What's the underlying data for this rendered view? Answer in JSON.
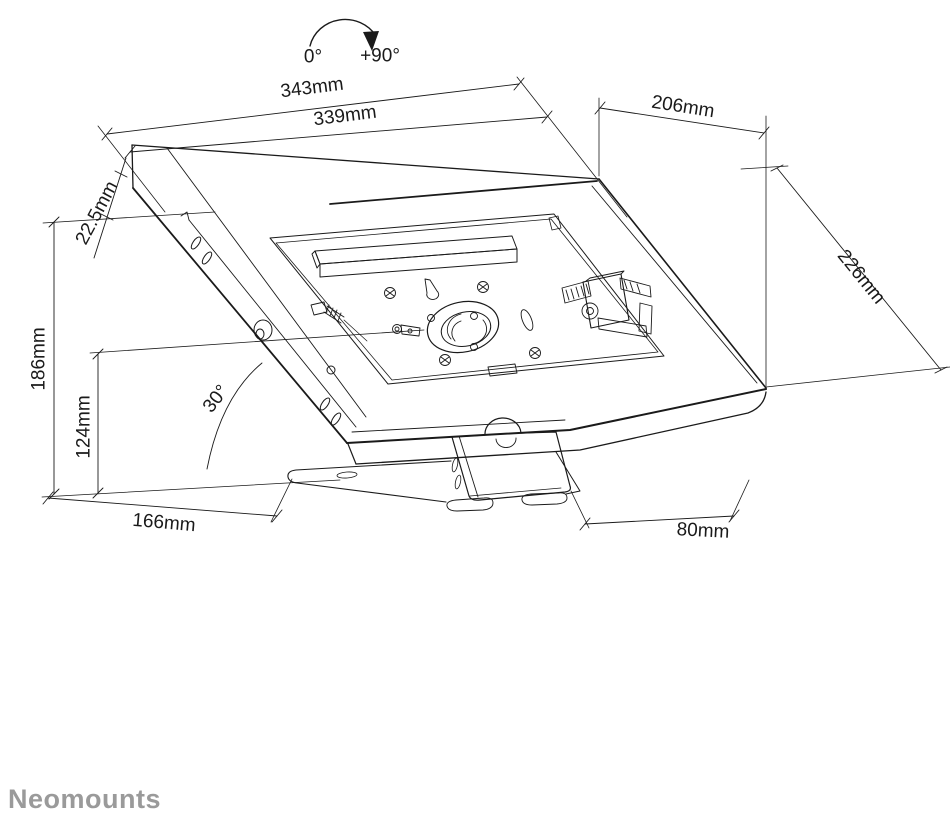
{
  "drawing": {
    "title": "tablet-stand-dimension-diagram",
    "brand": "Neomounts",
    "rotation": {
      "start": "0°",
      "end": "+90°"
    },
    "dimensions": {
      "top_width": "343mm",
      "inner_width": "339mm",
      "top_depth": "206mm",
      "edge_thickness": "22.5mm",
      "surface_depth": "226mm",
      "total_height": "186mm",
      "pivot_height": "124mm",
      "tilt_angle": "30°",
      "base_depth": "166mm",
      "foot_depth": "80mm"
    },
    "line_color": "#1a1a1a",
    "background_color": "#ffffff",
    "brand_color": "#9a9a9a"
  }
}
